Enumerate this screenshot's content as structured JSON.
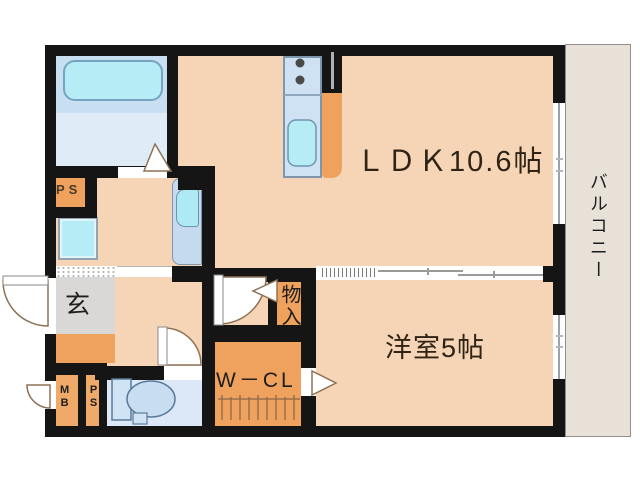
{
  "title": "apartment-floorplan",
  "rooms": {
    "ldk": {
      "label": "ＬＤＫ10.6帖"
    },
    "western_room": {
      "label": "洋室5帖"
    },
    "balcony": {
      "label": "バルコニー"
    },
    "entrance": {
      "label": "玄"
    },
    "storage": {
      "label": "物入"
    },
    "walk_in_closet": {
      "label": "W－CL"
    },
    "pipe_shaft_upper": {
      "label": "PS"
    },
    "meter_box": {
      "label": "MB"
    },
    "pipe_shaft_lower": {
      "label": "PS"
    }
  },
  "fixtures": [
    "bathtub",
    "kitchen-counter",
    "stove-burners",
    "kitchen-sink",
    "washing-machine-pan",
    "vanity-basin",
    "toilet",
    "hanger-rail",
    "entrance-door",
    "bathroom-folding-door",
    "toilet-door",
    "room-door",
    "storage-door-arrow",
    "closet-door-arrow",
    "window",
    "sliding-partition"
  ],
  "colors": {
    "wall": "#151515",
    "floor_pink": "#f6d5b6",
    "accent_orange": "#efa25e",
    "mbps_orange": "#efa968",
    "entrance_mat_gray": "#d9d8d6",
    "bath_floor_upper": "#c8def1",
    "bath_floor_lower": "#e0ebf8",
    "tub_cyan": "#b6ecf5",
    "toilet_floor": "#dce8f7",
    "fixture_blue": "#cfe2f3",
    "balcony_beige": "#e7e1d8",
    "door_stroke": "#8d7256"
  }
}
